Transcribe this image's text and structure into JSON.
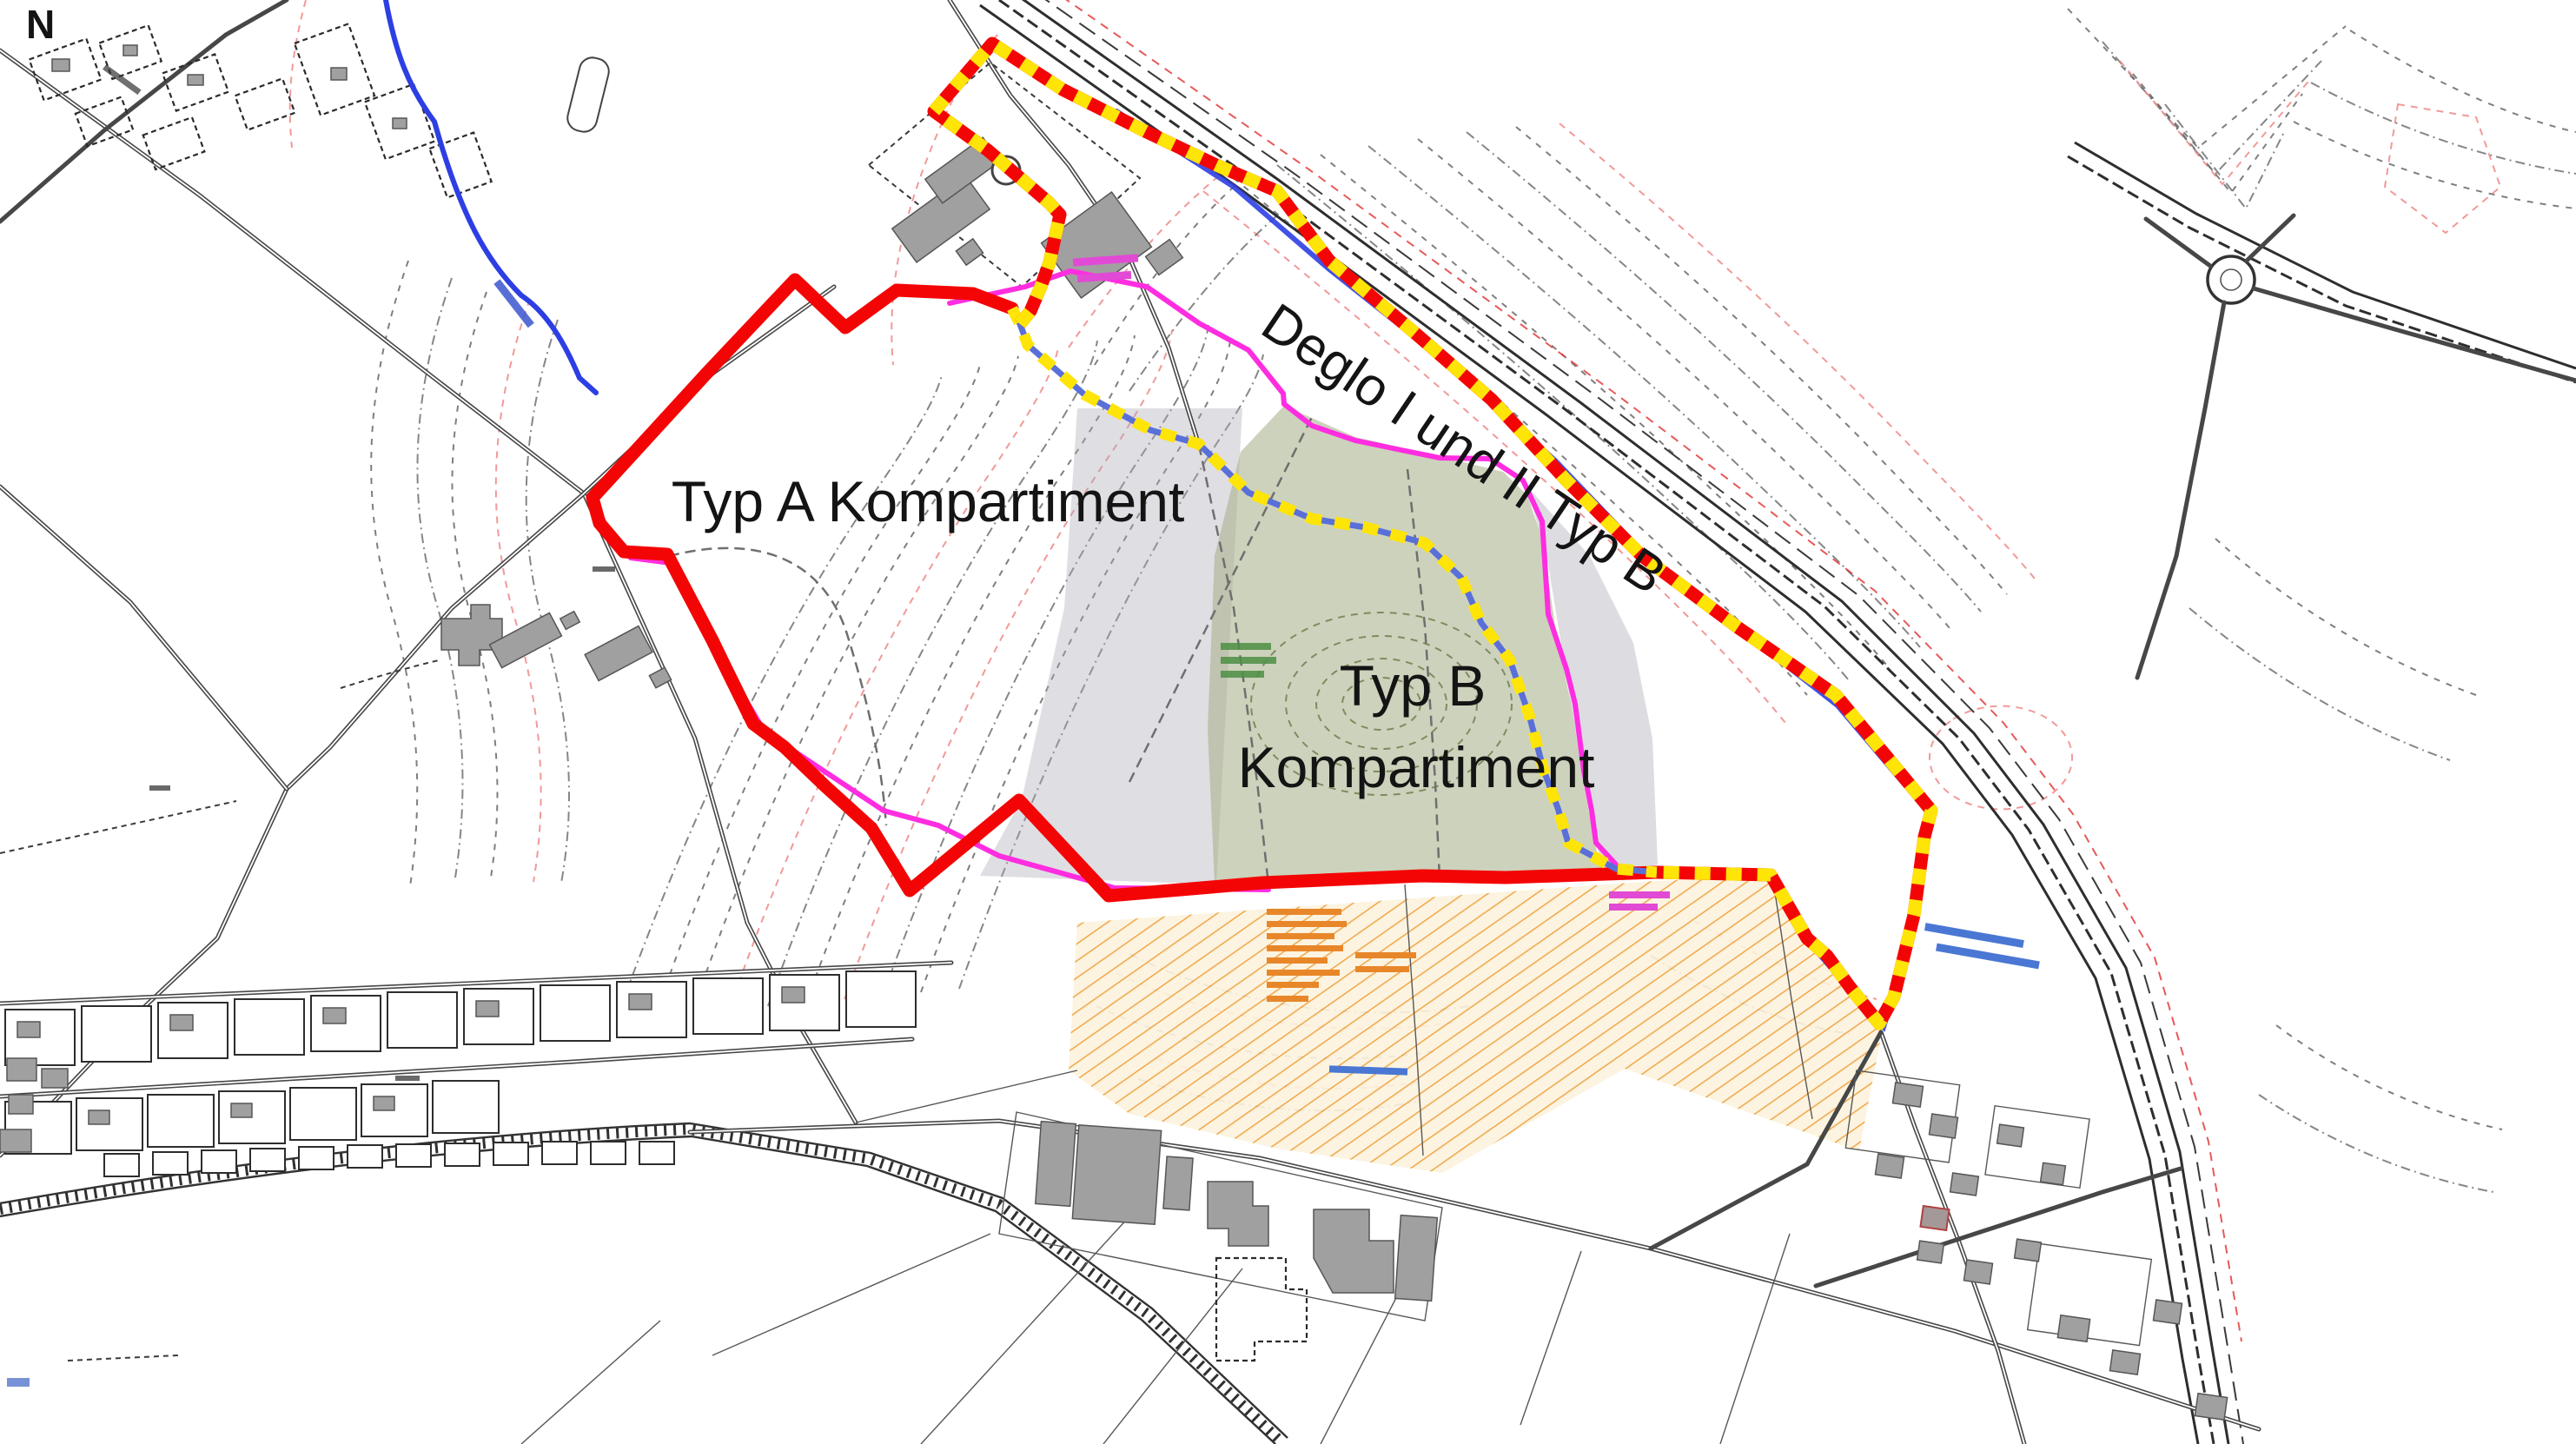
{
  "map": {
    "north_label": "N",
    "labels": {
      "typ_a": "Typ A Kompartiment",
      "typ_b_line1": "Typ B",
      "typ_b_line2": "Kompartiment",
      "deglo": "Deglo I und II Typ B"
    },
    "zones": [
      {
        "name": "Typ A Kompartiment",
        "boundary_style": "solid red line"
      },
      {
        "name": "Typ B Kompartiment",
        "boundary_style": "yellow dashed line over blue",
        "fill": "translucent green"
      },
      {
        "name": "Deglo I und II Typ B",
        "boundary_style": "red and yellow dashed line"
      }
    ],
    "colors": {
      "boundary_red": "#f40505",
      "boundary_yellow": "#ffe408",
      "divider_blue": "#5a6fd8",
      "stream_blue": "#2d3fe3",
      "magenta": "#ff2de0",
      "zone_green": "#a4ad85",
      "zone_gray": "#aaa7b5",
      "hatch_orange": "#efa13f",
      "hatch_bg": "#fcf3dd",
      "contour_gray": "#686868",
      "contour_red": "#ef8e8e",
      "road_gray": "#474747",
      "building_gray": "#a0a0a0",
      "label_black": "#141414"
    }
  }
}
